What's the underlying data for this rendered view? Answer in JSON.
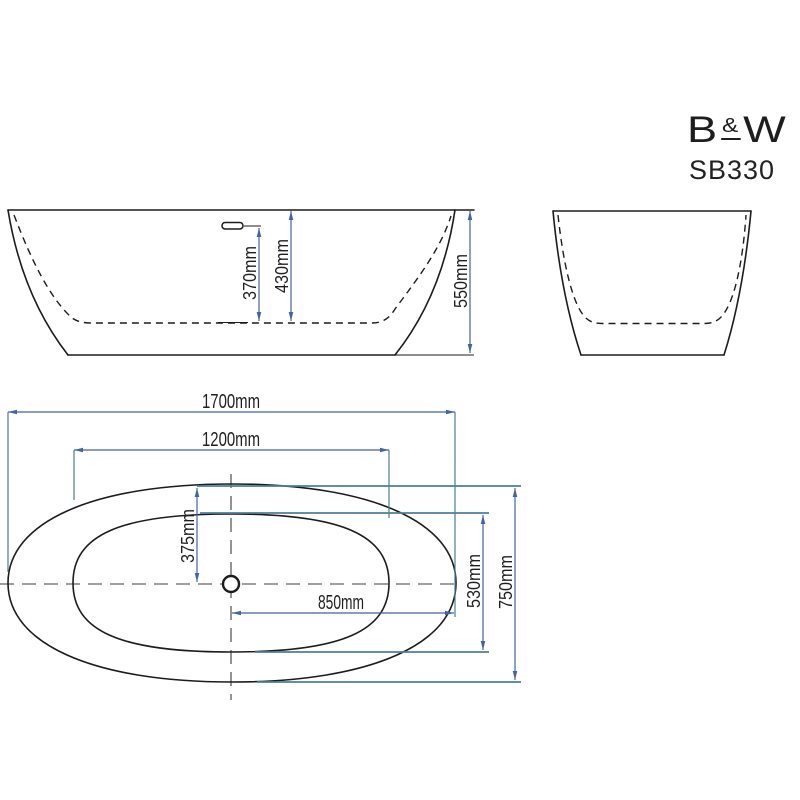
{
  "brand": {
    "letter_b": "B",
    "ampersand": "&",
    "letter_w": "W",
    "model": "SB330"
  },
  "front_view": {
    "overflow_height": "370mm",
    "inner_depth": "430mm",
    "total_height": "550mm"
  },
  "plan_view": {
    "overall_length": "1700mm",
    "inner_length": "1200mm",
    "center_to_end": "850mm",
    "center_to_side": "375mm",
    "inner_width": "530mm",
    "overall_width": "750mm"
  },
  "colors": {
    "dimension_line": "#41659c",
    "extension_line": "#4a7f99",
    "drawing_ink": "#1c1c1c",
    "background": "#ffffff"
  }
}
